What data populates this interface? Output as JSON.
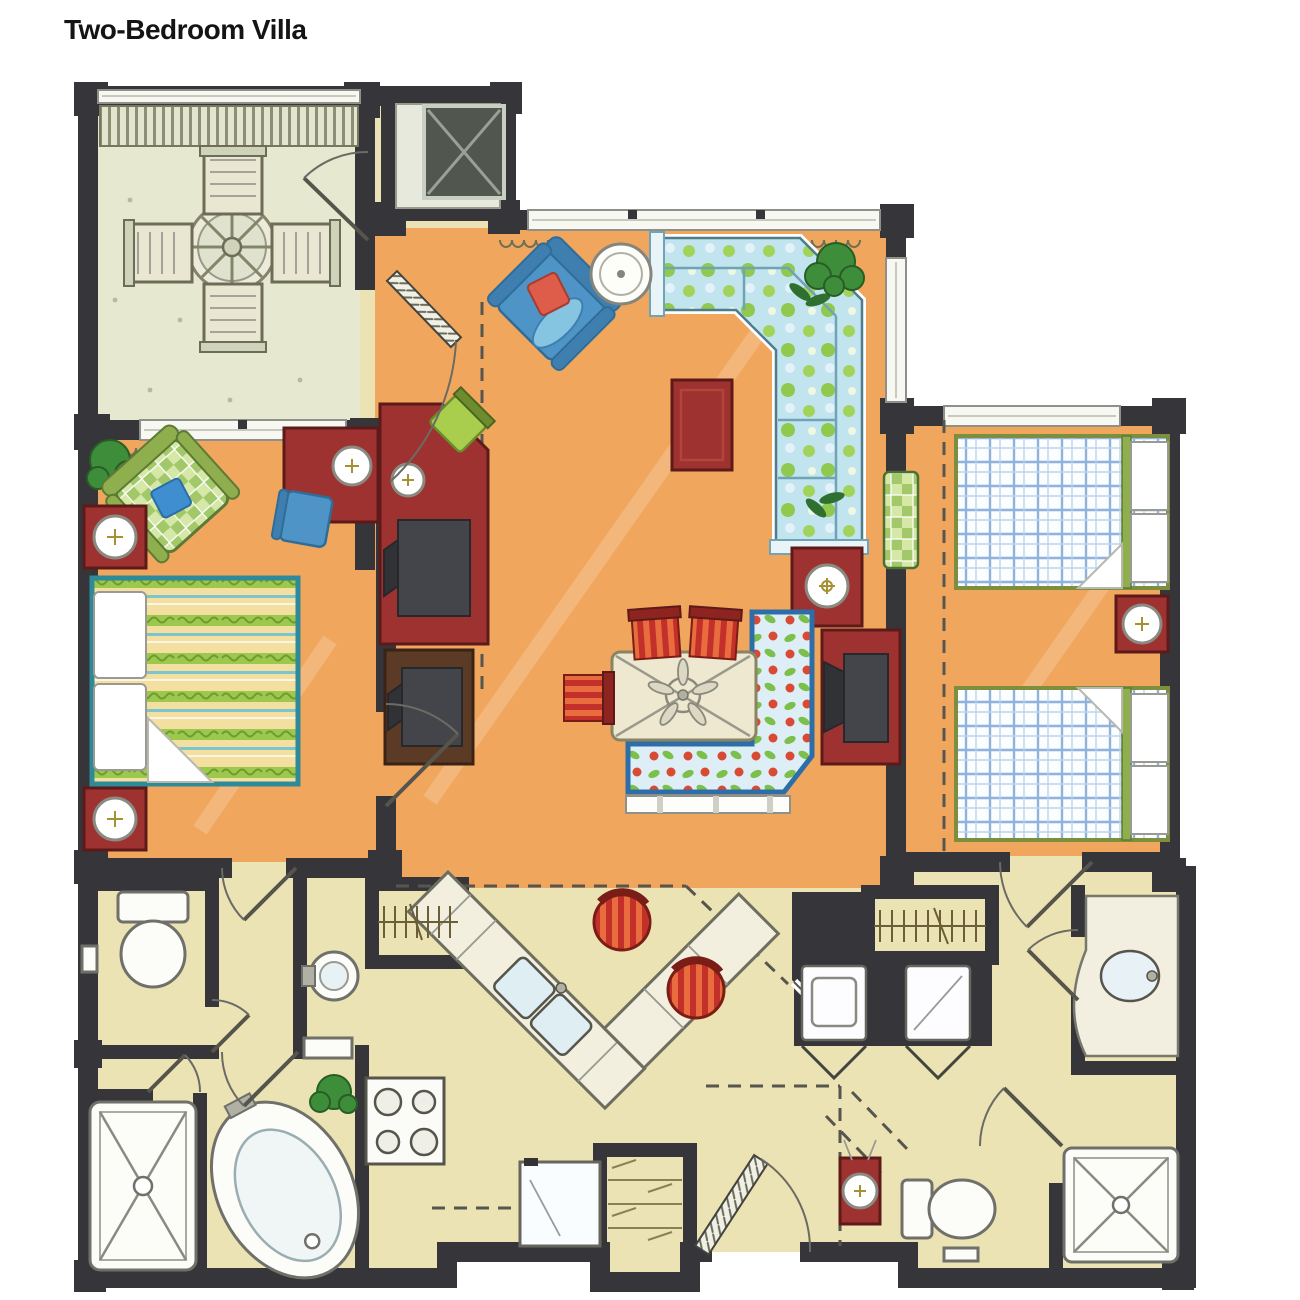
{
  "title": {
    "text": "Two-Bedroom Villa"
  },
  "palette": {
    "wall": "#35353a",
    "floor_orange": "#f1a65e",
    "floor_pale": "#ece3b4",
    "floor_balcony": "#e6e9d0",
    "wood_red": "#9e3230",
    "wood_brown": "#5c3b26",
    "chair_blue": "#4f94c6",
    "plant_green": "#3e8d3b",
    "sofa_floral_blue": "#c2e4ef",
    "sofa_floral_green": "#9fd34f",
    "banquette_blue": "#2d6ea8",
    "bed_plaid_blue": "#8fb3dc",
    "bed_master_yellow": "#f3dfa0",
    "bed_master_green": "#9cc84e",
    "stool_red": "#c3302a",
    "accent_pillow_red": "#dd5c4a"
  },
  "floor_plan": {
    "rooms": [
      {
        "name": "Balcony",
        "furniture": [
          "round patio table with umbrella",
          "patio chair x4",
          "pergola slats",
          "door to foyer"
        ]
      },
      {
        "name": "Living Room",
        "furniture": [
          "L-shaped floral sectional sofa",
          "blue armchair with red pillow",
          "round side table",
          "red coffee table",
          "red side table with lamp",
          "corner plant",
          "green wall bench"
        ]
      },
      {
        "name": "Dining Nook",
        "furniture": [
          "square table with ceiling fan",
          "L-shaped floral banquette",
          "striped dining chair x3",
          "red media console with TV"
        ]
      },
      {
        "name": "Master Bedroom",
        "furniture": [
          "king bed with striped spread",
          "nightstand with lamp x2",
          "green plaid armchair with blue pillow",
          "potted plant",
          "red desk with lamp and blue chair",
          "corner desk unit with green chair, lamp and TV",
          "brown TV cabinet"
        ]
      },
      {
        "name": "Bedroom 2",
        "furniture": [
          "plaid double bed x2",
          "nightstand with lamp",
          "red console with lamp at hall"
        ]
      },
      {
        "name": "Kitchen",
        "furniture": [
          "angled counter with double sink",
          "red bar stool x2",
          "range with 4 burners",
          "refrigerator",
          "hanging closet",
          "pantry shelves"
        ]
      },
      {
        "name": "Master Bathroom",
        "furniture": [
          "water closet with toilet",
          "pedestal sink",
          "corner shower",
          "oval bathtub",
          "small plant"
        ]
      },
      {
        "name": "Bathroom 2",
        "furniture": [
          "hanging closet",
          "corner coat closet",
          "washer",
          "dryer",
          "vanity with oval sink",
          "corner shower",
          "toilet"
        ]
      },
      {
        "name": "Foyer / Entry",
        "furniture": [
          "entry door",
          "utility shaft"
        ]
      }
    ]
  }
}
